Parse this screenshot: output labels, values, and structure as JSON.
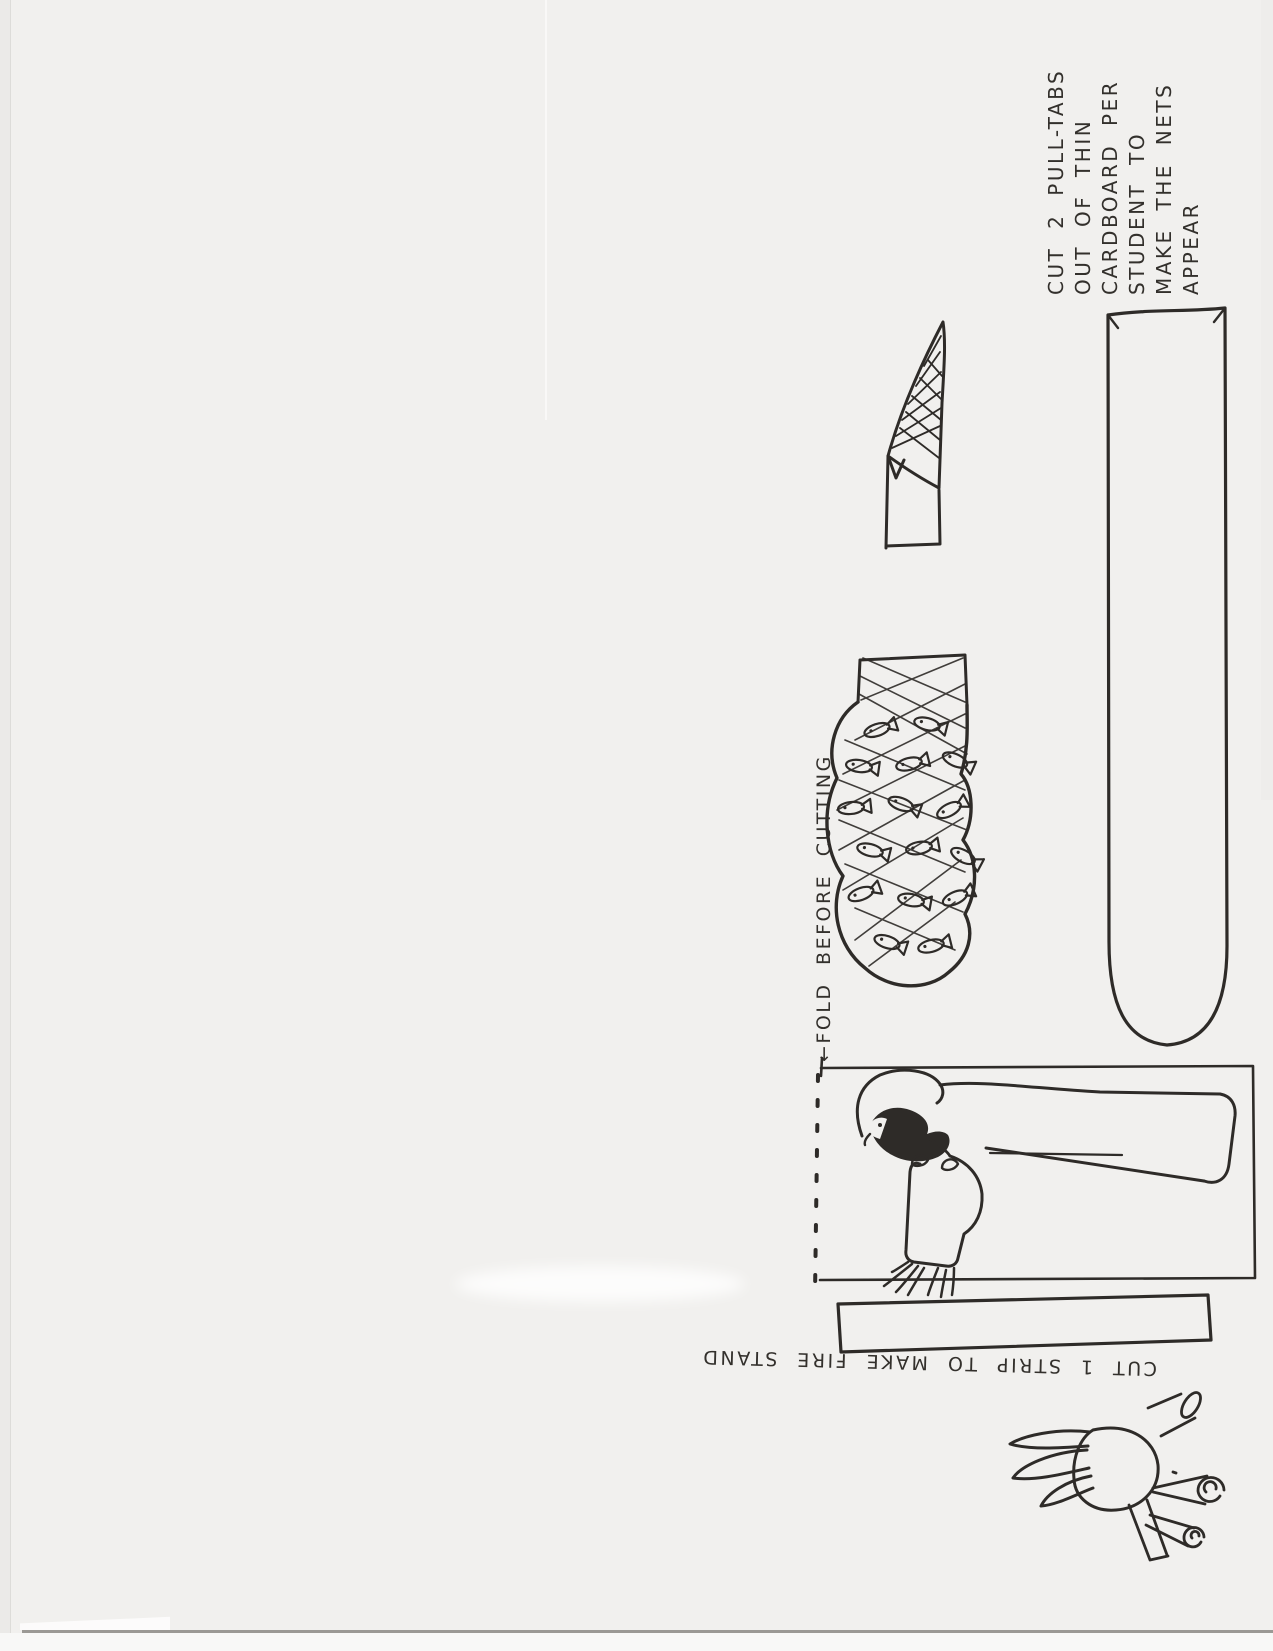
{
  "document": {
    "kind": "scanned hand-drawn craft template page",
    "rotation": "drawing content is rotated 90 degrees counter-clockwise on the scan"
  },
  "annotations": {
    "pull_tab_instructions": {
      "lines": [
        "CUT 2 PULL-TABS",
        "OUT OF THIN",
        "CARDBOARD PER",
        "STUDENT TO",
        "MAKE THE NETS",
        "APPEAR"
      ]
    },
    "fold_instruction": {
      "text": "←FOLD BEFORE CUTTING"
    },
    "strip_instruction": {
      "text": "CUT 1 STRIP TO MAKE FIRE STAND"
    }
  },
  "drawings": {
    "pull_tab_template": "long blank pull-tab with rounded end",
    "net_corner_tab": "small tab with cross-hatched net corner",
    "net_full_of_fish": "bulging net packed with fish",
    "robed_figure": "robed figure with outstretched hands inside cut-out rectangle",
    "fold_line": "dashed fold line",
    "fire_stand_strip": "blank strip for fire stand",
    "campfire": "campfire of crossed logs and flames"
  },
  "colors": {
    "paper": "#f1f0ee",
    "ink": "#2e2b28",
    "backing": "#f8f8f7",
    "paper_edge": "#9b9995"
  }
}
